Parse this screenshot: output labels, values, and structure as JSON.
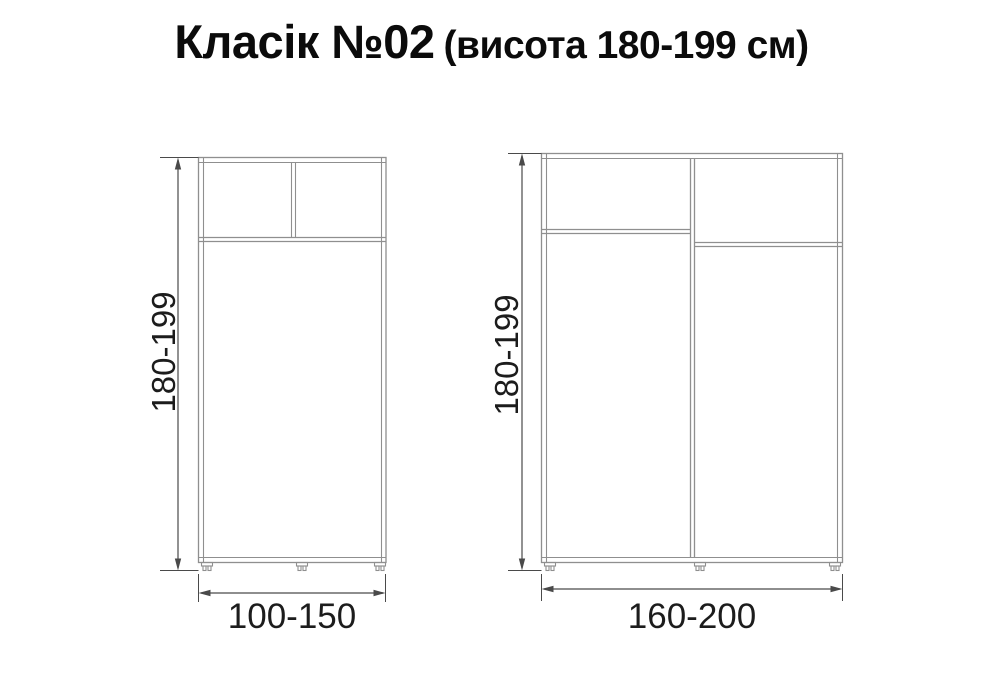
{
  "title": {
    "main": "Класік №02",
    "suffix": "(висота 180-199 см)"
  },
  "colors": {
    "page_bg": "#ffffff",
    "furniture_line": "#8f8f8f",
    "dimension_line": "#4a4a4a",
    "title_color": "#0b0b0b",
    "label_color": "#1c1c1c"
  },
  "wardrobes": [
    {
      "id": "left-small-wardrobe",
      "height_label": "180-199",
      "width_label": "100-150",
      "sections": "two-door mezzanine top, single lower section, three adjustable feet"
    },
    {
      "id": "right-large-wardrobe",
      "height_label": "180-199",
      "width_label": "160-200",
      "sections": "two columns with mezzanine compartments at different heights, three adjustable feet"
    }
  ]
}
